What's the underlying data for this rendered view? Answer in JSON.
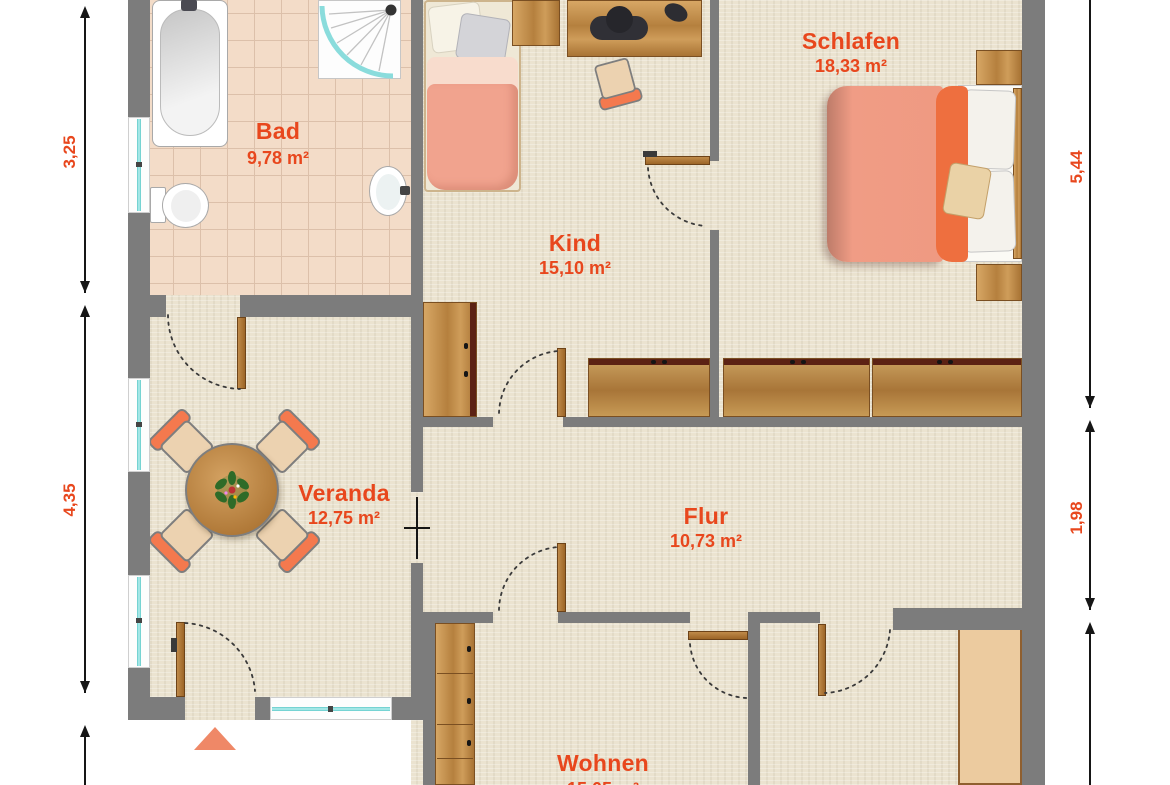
{
  "plan_type": "apartment-floor-plan",
  "rooms": [
    {
      "name": "Bad",
      "area": "9,78 m²"
    },
    {
      "name": "Kind",
      "area": "15,10 m²"
    },
    {
      "name": "Schlafen",
      "area": "18,33 m²"
    },
    {
      "name": "Veranda",
      "area": "12,75 m²"
    },
    {
      "name": "Flur",
      "area": "10,73 m²"
    },
    {
      "name": "Wohnen",
      "area": "15,05 m²"
    }
  ],
  "dimensions": {
    "left": [
      "3,25",
      "4,35"
    ],
    "right": [
      "5,44",
      "1,98"
    ]
  },
  "colors": {
    "label_text": "#e8471d",
    "dimension_text": "#e8471d",
    "wall": "#7c7c7c",
    "floor_carpet": "#ebe3d0",
    "floor_tile": "#f3dcc8",
    "window_glass": "#7fd8d8",
    "wood_furniture": "#b5803e",
    "bed_salmon": "#f09a82",
    "duvet_fold_orange": "#ee6f3f",
    "chair_orange": "#f4794e",
    "entrance_arrow": "#ef8867"
  }
}
